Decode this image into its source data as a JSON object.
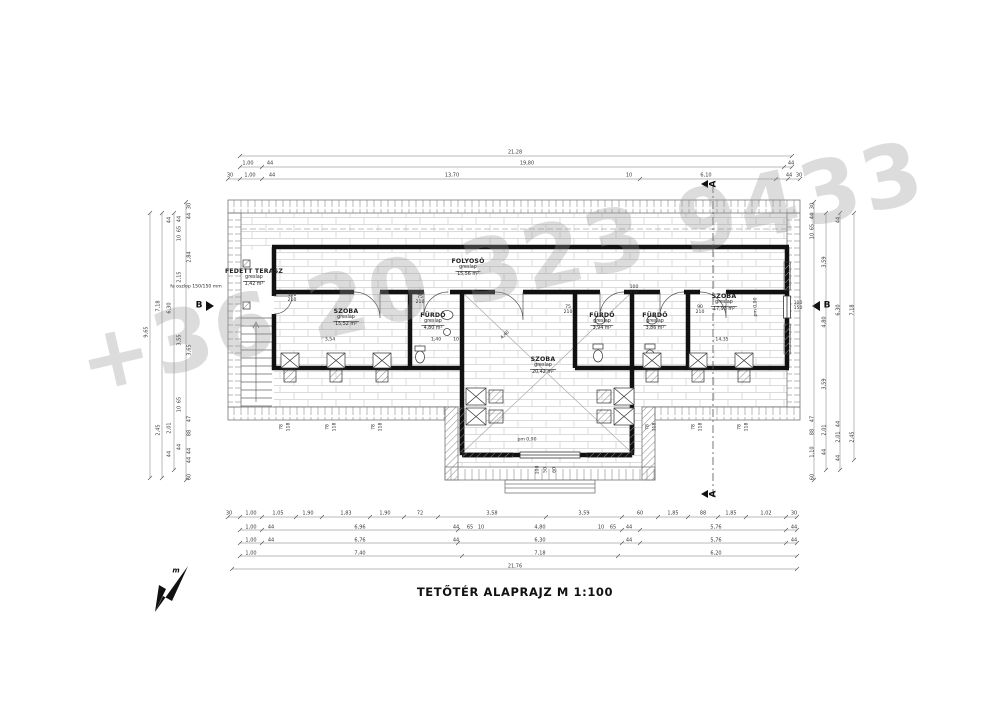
{
  "meta": {
    "title": "TETŐTÉR ALAPRAJZ  M 1:100",
    "watermark": "+36 20 323 9433"
  },
  "colors": {
    "line": "#111111",
    "dim": "#3a3a3a",
    "brick": "#cfcfcf",
    "hatch": "#888888",
    "watermark": "#969696"
  },
  "rooms": [
    {
      "name": "FEDETT TERASZ",
      "finish": "greslap",
      "area": "1,42 m²",
      "x": 254,
      "y": 278
    },
    {
      "name": "FOLYOSÓ",
      "finish": "greslap",
      "area": "15,56 m²",
      "x": 468,
      "y": 268
    },
    {
      "name": "SZOBA",
      "finish": "greslap",
      "area": "15,52 m²",
      "x": 346,
      "y": 318
    },
    {
      "name": "FÜRDŐ",
      "finish": "greslap",
      "area": "4,80 m²",
      "x": 433,
      "y": 322
    },
    {
      "name": "SZOBA",
      "finish": "greslap",
      "area": "20,42 m²",
      "x": 543,
      "y": 366
    },
    {
      "name": "FÜRDŐ",
      "finish": "greslap",
      "area": "3,94 m²",
      "x": 602,
      "y": 322
    },
    {
      "name": "FÜRDŐ",
      "finish": "greslap",
      "area": "3,86 m²",
      "x": 655,
      "y": 322
    },
    {
      "name": "SZOBA",
      "finish": "greslap",
      "area": "17,93 m²",
      "x": 724,
      "y": 303
    }
  ],
  "dim_labels": [
    {
      "t": "21,28",
      "x": 515,
      "y": 153
    },
    {
      "t": "1,00",
      "x": 248,
      "y": 164
    },
    {
      "t": "44",
      "x": 270,
      "y": 164
    },
    {
      "t": "19,80",
      "x": 527,
      "y": 164
    },
    {
      "t": "44",
      "x": 791,
      "y": 164
    },
    {
      "t": "30",
      "x": 230,
      "y": 176
    },
    {
      "t": "1,00",
      "x": 250,
      "y": 176
    },
    {
      "t": "44",
      "x": 272,
      "y": 176
    },
    {
      "t": "13,70",
      "x": 452,
      "y": 176
    },
    {
      "t": "10",
      "x": 629,
      "y": 176
    },
    {
      "t": "6,10",
      "x": 706,
      "y": 176
    },
    {
      "t": "44",
      "x": 789,
      "y": 176
    },
    {
      "t": "30",
      "x": 799,
      "y": 176
    },
    {
      "t": "30",
      "x": 229,
      "y": 514
    },
    {
      "t": "1,00",
      "x": 251,
      "y": 514
    },
    {
      "t": "1,05",
      "x": 278,
      "y": 514
    },
    {
      "t": "1,90",
      "x": 308,
      "y": 514
    },
    {
      "t": "1,83",
      "x": 346,
      "y": 514
    },
    {
      "t": "1,90",
      "x": 385,
      "y": 514
    },
    {
      "t": "72",
      "x": 420,
      "y": 514
    },
    {
      "t": "3,58",
      "x": 492,
      "y": 514
    },
    {
      "t": "3,59",
      "x": 584,
      "y": 514
    },
    {
      "t": "60",
      "x": 640,
      "y": 514
    },
    {
      "t": "1,85",
      "x": 673,
      "y": 514
    },
    {
      "t": "88",
      "x": 703,
      "y": 514
    },
    {
      "t": "1,85",
      "x": 731,
      "y": 514
    },
    {
      "t": "1,02",
      "x": 766,
      "y": 514
    },
    {
      "t": "30",
      "x": 794,
      "y": 514
    },
    {
      "t": "1,00",
      "x": 251,
      "y": 528
    },
    {
      "t": "44",
      "x": 271,
      "y": 528
    },
    {
      "t": "6,96",
      "x": 360,
      "y": 528
    },
    {
      "t": "44",
      "x": 456,
      "y": 528
    },
    {
      "t": "65",
      "x": 470,
      "y": 528
    },
    {
      "t": "10",
      "x": 481,
      "y": 528
    },
    {
      "t": "4,80",
      "x": 540,
      "y": 528
    },
    {
      "t": "10",
      "x": 601,
      "y": 528
    },
    {
      "t": "65",
      "x": 613,
      "y": 528
    },
    {
      "t": "44",
      "x": 629,
      "y": 528
    },
    {
      "t": "5,76",
      "x": 716,
      "y": 528
    },
    {
      "t": "44",
      "x": 794,
      "y": 528
    },
    {
      "t": "1,00",
      "x": 251,
      "y": 541
    },
    {
      "t": "44",
      "x": 271,
      "y": 541
    },
    {
      "t": "6,76",
      "x": 360,
      "y": 541
    },
    {
      "t": "44",
      "x": 456,
      "y": 541
    },
    {
      "t": "6,30",
      "x": 540,
      "y": 541
    },
    {
      "t": "44",
      "x": 629,
      "y": 541
    },
    {
      "t": "5,76",
      "x": 716,
      "y": 541
    },
    {
      "t": "44",
      "x": 794,
      "y": 541
    },
    {
      "t": "1,00",
      "x": 251,
      "y": 554
    },
    {
      "t": "7,40",
      "x": 360,
      "y": 554
    },
    {
      "t": "7,18",
      "x": 540,
      "y": 554
    },
    {
      "t": "6,20",
      "x": 716,
      "y": 554
    },
    {
      "t": "21,76",
      "x": 515,
      "y": 567
    },
    {
      "t": "9,65",
      "x": 147,
      "y": 332,
      "r": -90
    },
    {
      "t": "7,18",
      "x": 159,
      "y": 306,
      "r": -90
    },
    {
      "t": "2,45",
      "x": 159,
      "y": 430,
      "r": -90
    },
    {
      "t": "44",
      "x": 170,
      "y": 220,
      "r": -90
    },
    {
      "t": "6,30",
      "x": 170,
      "y": 308,
      "r": -90
    },
    {
      "t": "2,01",
      "x": 170,
      "y": 428,
      "r": -90
    },
    {
      "t": "44",
      "x": 170,
      "y": 454,
      "r": -90
    },
    {
      "t": "44",
      "x": 180,
      "y": 219,
      "r": -90
    },
    {
      "t": "65",
      "x": 180,
      "y": 229,
      "r": -90
    },
    {
      "t": "10",
      "x": 180,
      "y": 238,
      "r": -90
    },
    {
      "t": "2,15",
      "x": 180,
      "y": 277,
      "r": -90
    },
    {
      "t": "3,55",
      "x": 180,
      "y": 340,
      "r": -90
    },
    {
      "t": "65",
      "x": 180,
      "y": 400,
      "r": -90
    },
    {
      "t": "10",
      "x": 180,
      "y": 409,
      "r": -90
    },
    {
      "t": "44",
      "x": 180,
      "y": 447,
      "r": -90
    },
    {
      "t": "30",
      "x": 190,
      "y": 206,
      "r": -90
    },
    {
      "t": "44",
      "x": 190,
      "y": 216,
      "r": -90
    },
    {
      "t": "2,84",
      "x": 190,
      "y": 257,
      "r": -90
    },
    {
      "t": "3,65",
      "x": 190,
      "y": 350,
      "r": -90
    },
    {
      "t": "47",
      "x": 190,
      "y": 419,
      "r": -90
    },
    {
      "t": "88",
      "x": 190,
      "y": 433,
      "r": -90
    },
    {
      "t": "44",
      "x": 190,
      "y": 451,
      "r": -90
    },
    {
      "t": "44",
      "x": 190,
      "y": 460,
      "r": -90
    },
    {
      "t": "60",
      "x": 190,
      "y": 477,
      "r": -90
    },
    {
      "t": "30",
      "x": 813,
      "y": 206,
      "r": -90
    },
    {
      "t": "44",
      "x": 813,
      "y": 216,
      "r": -90
    },
    {
      "t": "65",
      "x": 813,
      "y": 227,
      "r": -90
    },
    {
      "t": "10",
      "x": 813,
      "y": 236,
      "r": -90
    },
    {
      "t": "47",
      "x": 813,
      "y": 419,
      "r": -90
    },
    {
      "t": "88",
      "x": 813,
      "y": 432,
      "r": -90
    },
    {
      "t": "1,10",
      "x": 813,
      "y": 452,
      "r": -90
    },
    {
      "t": "60",
      "x": 813,
      "y": 477,
      "r": -90
    },
    {
      "t": "3,59",
      "x": 825,
      "y": 262,
      "r": -90
    },
    {
      "t": "4,80",
      "x": 825,
      "y": 322,
      "r": -90
    },
    {
      "t": "3,59",
      "x": 825,
      "y": 384,
      "r": -90
    },
    {
      "t": "2,01",
      "x": 825,
      "y": 430,
      "r": -90
    },
    {
      "t": "44",
      "x": 825,
      "y": 452,
      "r": -90
    },
    {
      "t": "44",
      "x": 839,
      "y": 220,
      "r": -90
    },
    {
      "t": "6,30",
      "x": 839,
      "y": 310,
      "r": -90
    },
    {
      "t": "44",
      "x": 839,
      "y": 424,
      "r": -90
    },
    {
      "t": "2,01",
      "x": 839,
      "y": 437,
      "r": -90
    },
    {
      "t": "44",
      "x": 839,
      "y": 458,
      "r": -90
    },
    {
      "t": "7,18",
      "x": 853,
      "y": 310,
      "r": -90
    },
    {
      "t": "2,45",
      "x": 853,
      "y": 437,
      "r": -90
    }
  ],
  "annotations": [
    {
      "t": "fa oszlop 150/150 mm",
      "x": 196,
      "y": 288
    },
    {
      "t": "100\n210",
      "x": 292,
      "y": 299
    },
    {
      "t": "100\n210",
      "x": 634,
      "y": 291
    },
    {
      "t": "75\n210",
      "x": 420,
      "y": 301
    },
    {
      "t": "75\n210",
      "x": 568,
      "y": 311
    },
    {
      "t": "90\n210",
      "x": 700,
      "y": 311
    },
    {
      "t": "100\n150",
      "x": 798,
      "y": 307
    },
    {
      "t": "pm 0,90",
      "x": 757,
      "y": 307,
      "r": -90
    },
    {
      "t": "pm 0,90",
      "x": 527,
      "y": 441
    },
    {
      "t": "100",
      "x": 539,
      "y": 470,
      "r": -90
    },
    {
      "t": "50",
      "x": 547,
      "y": 470,
      "r": -90
    },
    {
      "t": "60",
      "x": 556,
      "y": 470,
      "r": -90
    },
    {
      "t": "78",
      "x": 283,
      "y": 427,
      "r": -90
    },
    {
      "t": "118",
      "x": 290,
      "y": 427,
      "r": -90
    },
    {
      "t": "78",
      "x": 329,
      "y": 427,
      "r": -90
    },
    {
      "t": "118",
      "x": 336,
      "y": 427,
      "r": -90
    },
    {
      "t": "78",
      "x": 375,
      "y": 427,
      "r": -90
    },
    {
      "t": "118",
      "x": 382,
      "y": 427,
      "r": -90
    },
    {
      "t": "78",
      "x": 649,
      "y": 427,
      "r": -90
    },
    {
      "t": "118",
      "x": 656,
      "y": 427,
      "r": -90
    },
    {
      "t": "78",
      "x": 695,
      "y": 427,
      "r": -90
    },
    {
      "t": "118",
      "x": 702,
      "y": 427,
      "r": -90
    },
    {
      "t": "78",
      "x": 741,
      "y": 427,
      "r": -90
    },
    {
      "t": "118",
      "x": 748,
      "y": 427,
      "r": -90
    },
    {
      "t": "1,40",
      "x": 436,
      "y": 341
    },
    {
      "t": "10",
      "x": 456,
      "y": 341
    },
    {
      "t": "14,35",
      "x": 722,
      "y": 341
    },
    {
      "t": "3,54",
      "x": 330,
      "y": 341
    },
    {
      "t": "4,40",
      "x": 506,
      "y": 336,
      "r": -44
    },
    {
      "t": "A",
      "x": 714,
      "y": 184,
      "r": -90,
      "cls": "section"
    },
    {
      "t": "A",
      "x": 714,
      "y": 494,
      "r": -90,
      "cls": "section"
    },
    {
      "t": "B",
      "x": 199,
      "y": 306,
      "cls": "section"
    },
    {
      "t": "B",
      "x": 827,
      "y": 306,
      "cls": "section"
    },
    {
      "t": "m",
      "x": 176,
      "y": 571,
      "cls": "logo-m"
    }
  ]
}
